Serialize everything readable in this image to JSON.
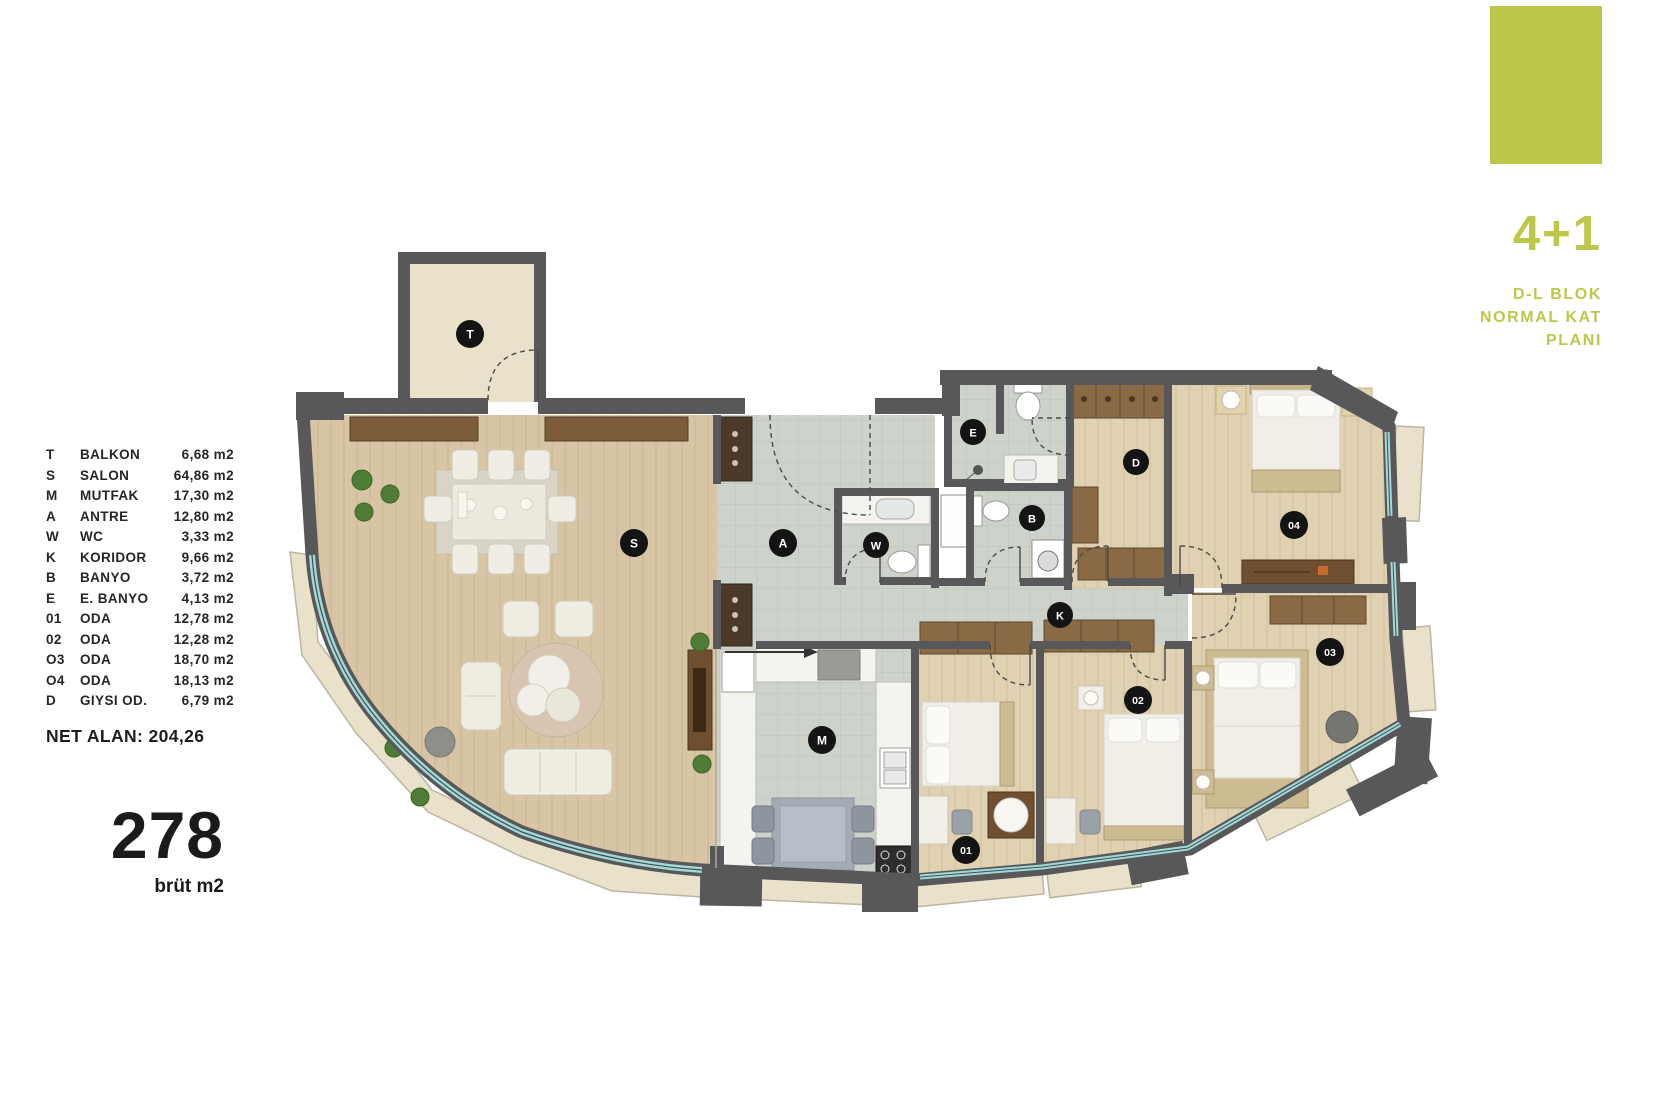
{
  "legend": {
    "items": [
      {
        "code": "T",
        "name": "BALKON",
        "area": "6,68 m2"
      },
      {
        "code": "S",
        "name": "SALON",
        "area": "64,86 m2"
      },
      {
        "code": "M",
        "name": "MUTFAK",
        "area": "17,30 m2"
      },
      {
        "code": "A",
        "name": "ANTRE",
        "area": "12,80 m2"
      },
      {
        "code": "W",
        "name": "WC",
        "area": "3,33 m2"
      },
      {
        "code": "K",
        "name": "KORIDOR",
        "area": "9,66 m2"
      },
      {
        "code": "B",
        "name": "BANYO",
        "area": "3,72 m2"
      },
      {
        "code": "E",
        "name": "E. BANYO",
        "area": "4,13 m2"
      },
      {
        "code": "01",
        "name": "ODA",
        "area": "12,78 m2"
      },
      {
        "code": "02",
        "name": "ODA",
        "area": "12,28 m2"
      },
      {
        "code": "O3",
        "name": "ODA",
        "area": "18,70 m2"
      },
      {
        "code": "O4",
        "name": "ODA",
        "area": "18,13 m2"
      },
      {
        "code": "D",
        "name": "GIYSI OD.",
        "area": "6,79 m2"
      }
    ],
    "net_alan": "NET ALAN: 204,26",
    "gross_value": "278",
    "gross_unit": "brüt m2"
  },
  "title_block": {
    "type": "4+1",
    "line1": "D-L BLOK",
    "line2": "NORMAL KAT",
    "line3": "PLANI",
    "accent_color": "#bdc84b"
  },
  "plan": {
    "room_labels": [
      {
        "char": "T"
      },
      {
        "char": "S"
      },
      {
        "char": "A"
      },
      {
        "char": "W"
      },
      {
        "char": "E"
      },
      {
        "char": "B"
      },
      {
        "char": "D"
      },
      {
        "char": "K"
      },
      {
        "char": "M"
      },
      {
        "char": "01"
      },
      {
        "char": "02"
      },
      {
        "char": "03"
      },
      {
        "char": "04"
      }
    ]
  },
  "colors": {
    "accent": "#bdc84b",
    "wall": "#58585b",
    "glass": "#9fd9d9",
    "wood": "#d8c5a5",
    "tile": "#cdd2cb",
    "terrace": "#e9e1ca"
  }
}
